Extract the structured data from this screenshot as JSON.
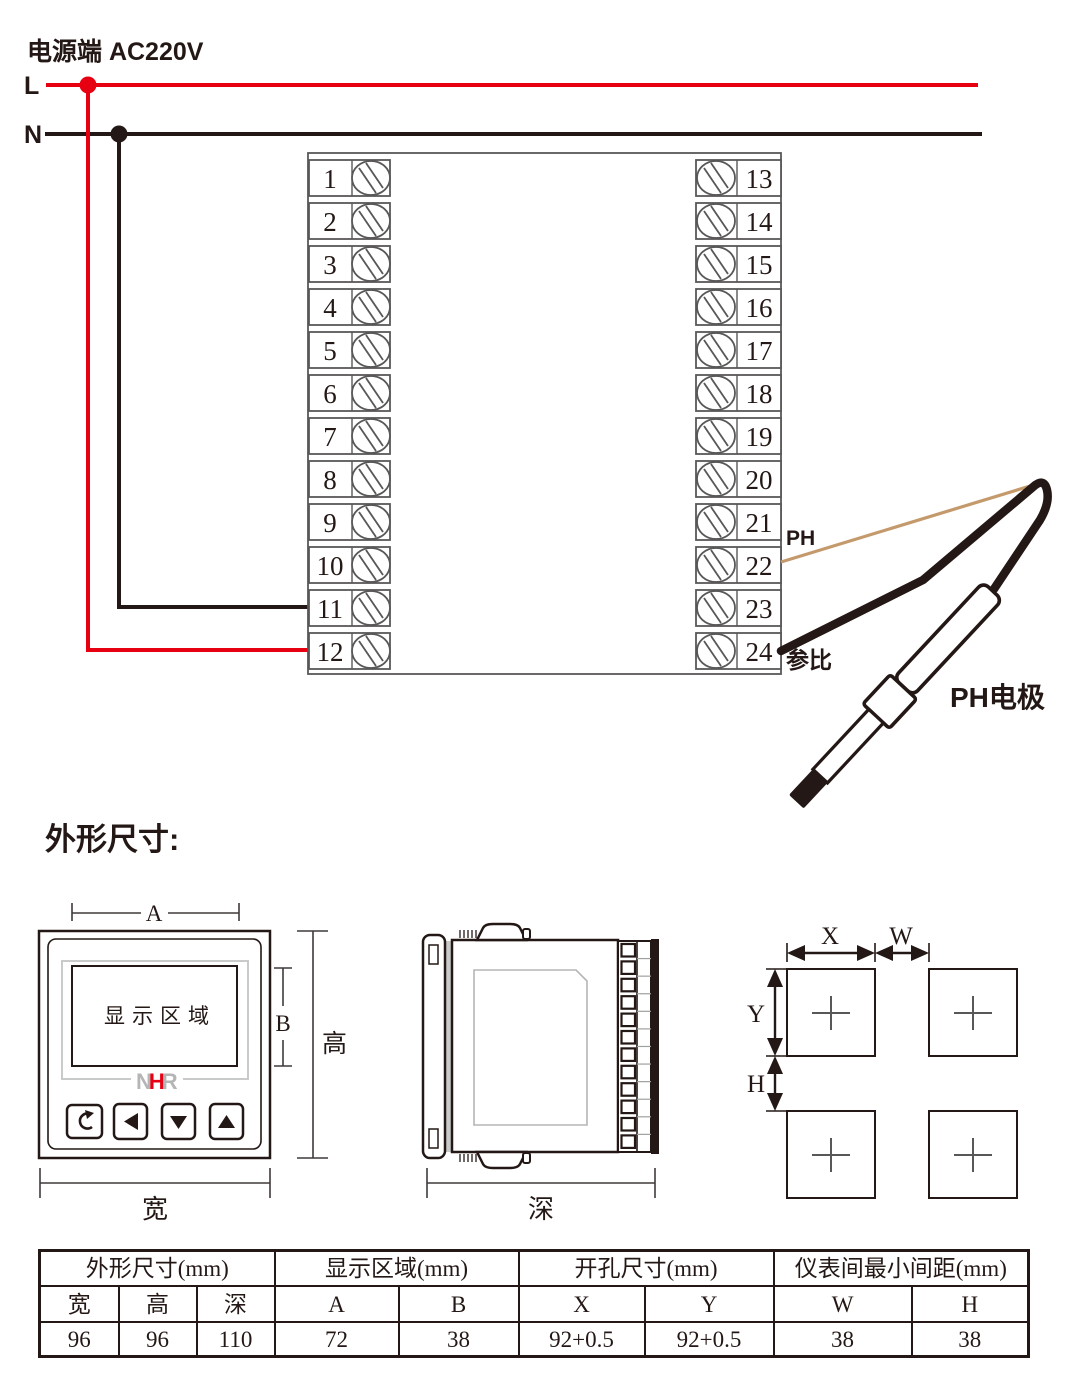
{
  "colors": {
    "red": "#e60012",
    "ink": "#231815",
    "tan": "#c49a6c",
    "terminal_stroke": "#595757",
    "light_gray": "#c9caca",
    "logo_gray": "#b5b5b6",
    "dim_line": "#3f3a39"
  },
  "power": {
    "label": "电源端 AC220V",
    "line_live": "L",
    "line_neutral": "N"
  },
  "terminal_block": {
    "left_terminals": [
      "1",
      "2",
      "3",
      "4",
      "5",
      "6",
      "7",
      "8",
      "9",
      "10",
      "11",
      "12"
    ],
    "right_terminals": [
      "13",
      "14",
      "15",
      "16",
      "17",
      "18",
      "19",
      "20",
      "21",
      "22",
      "23",
      "24"
    ]
  },
  "electrode": {
    "ph_wire_label": "PH",
    "reference_wire_label": "参比",
    "electrode_label": "PH电极"
  },
  "dimensions_section": {
    "heading": "外形尺寸:",
    "front_view": {
      "display_label": "显示区域",
      "logo_letters": [
        "N",
        "H",
        "R"
      ],
      "dim_a": "A",
      "dim_b": "B",
      "dim_height": "高",
      "dim_width": "宽"
    },
    "side_view": {
      "dim_depth": "深"
    },
    "cutout_view": {
      "dim_x": "X",
      "dim_w": "W",
      "dim_y": "Y",
      "dim_h": "H"
    }
  },
  "table": {
    "groups": [
      {
        "label": "外形尺寸(mm)",
        "span": 3
      },
      {
        "label": "显示区域(mm)",
        "span": 2
      },
      {
        "label": "开孔尺寸(mm)",
        "span": 2
      },
      {
        "label": "仪表间最小间距(mm)",
        "span": 2
      }
    ],
    "sub_headers": [
      "宽",
      "高",
      "深",
      "A",
      "B",
      "X",
      "Y",
      "W",
      "H"
    ],
    "values": [
      "96",
      "96",
      "110",
      "72",
      "38",
      "92+0.5",
      "92+0.5",
      "38",
      "38"
    ]
  }
}
